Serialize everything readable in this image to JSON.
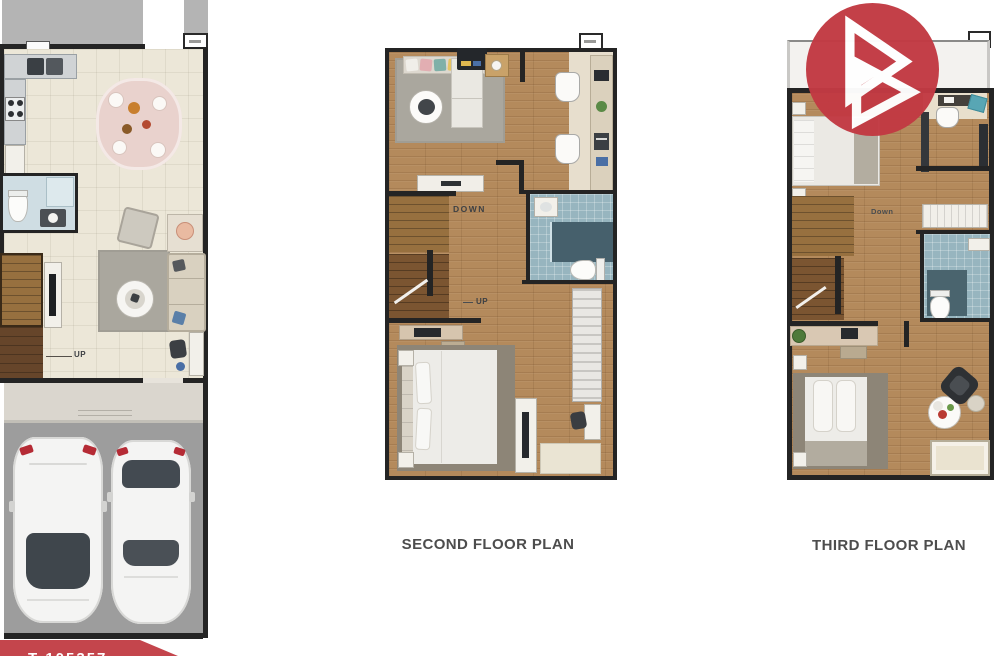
{
  "scene": {
    "description": "Real-estate listing image: three townhouse floor plans on white background",
    "background": "#ffffff"
  },
  "brand": {
    "logo_color": "#c23a43",
    "logo_glyph": "double-triangle-b-monogram",
    "banner_color": "#c4454c",
    "banner_partial_text": "T 105357"
  },
  "plan_first": {
    "name": "first floor plan (left, partially cropped)",
    "up_label": "UP",
    "rooms": [
      "kitchen",
      "dining area",
      "bathroom",
      "living room",
      "stairs",
      "porch",
      "garage with two cars"
    ]
  },
  "plan_second": {
    "label": "SECOND FLOOR PLAN",
    "down_label": "DOWN",
    "up_label": "UP",
    "rooms": [
      "bedroom with desk area",
      "bathroom",
      "stairs",
      "master bedroom",
      "balcony"
    ]
  },
  "plan_third": {
    "label": "THIRD FLOOR PLAN",
    "down_label": "Down",
    "rooms": [
      "bedroom with study nook",
      "bathroom",
      "stairs",
      "master bedroom with sitting table",
      "wardrobe"
    ]
  }
}
